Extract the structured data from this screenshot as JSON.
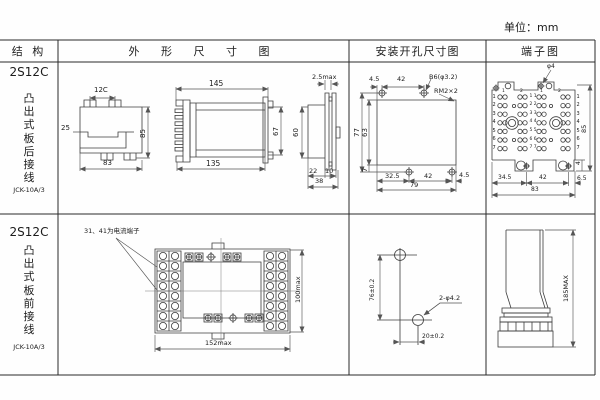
{
  "meta": {
    "unit": "单位：mm"
  },
  "headers": {
    "structure": "结 构",
    "outline": "外 形 尺 寸 图",
    "install": "安装开孔尺寸图",
    "terminal": "端子图"
  },
  "row1": {
    "model": "2S12C",
    "mount": "凸\n出\n式\n板\n后\n接\n线",
    "code": "JCK-10A/3",
    "outline": {
      "d12c": "12C",
      "d25": "25",
      "d85": "85",
      "d83": "83",
      "d145": "145",
      "d135": "135",
      "d67": "67",
      "d25max": "2.5max",
      "d60": "60",
      "d22": "22",
      "d10": "10",
      "d38": "38"
    },
    "install": {
      "d45_top": "4.5",
      "d42_top": "42",
      "hole": "B6(φ3.2)",
      "thread": "RM2×2",
      "d77": "77",
      "d63": "63",
      "d7": "7",
      "d325": "32.5",
      "d42_bot": "42",
      "d45_bot": "4.5",
      "d79": "79"
    },
    "terminal": {
      "phi4": "φ4",
      "d85": "85",
      "d4": "4",
      "d345": "34.5",
      "d42": "42",
      "d65": "6.5",
      "d83": "83",
      "rows_left": "1\n2\n3\n4\n5\n6\n7",
      "rows_right": "1\n2\n3\n4\n5\n6\n7",
      "rows_center": "1 1\n2 2\n3 3\n4 4\n5 5\n6 6\n7 7",
      "top_nums": [
        "1",
        "2",
        "1",
        "2"
      ]
    }
  },
  "row2": {
    "model": "2S12C",
    "mount": "凸\n出\n式\n板\n前\n接\n线",
    "code": "JCK-10A/3",
    "outline": {
      "note": "31、41为电流端子",
      "d100": "100max",
      "d152": "152max"
    },
    "install": {
      "d76": "76±0.2",
      "holes": "2-φ4.2",
      "d20": "20±0.2"
    },
    "terminal": {
      "d185": "185MAX"
    }
  }
}
